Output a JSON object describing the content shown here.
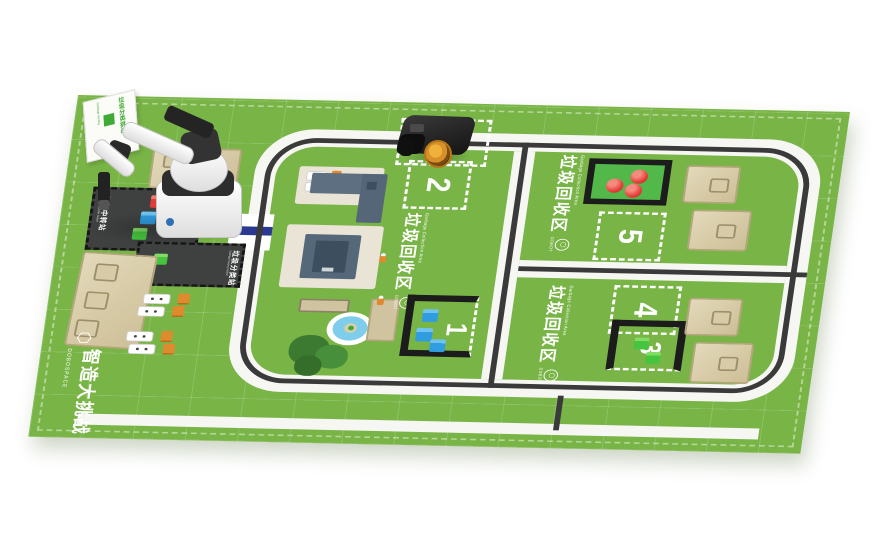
{
  "branding": {
    "logo_glyph": "⬡",
    "title_cn": "智造大挑战",
    "subtitle_en": "DOBOSPACE"
  },
  "sign": {
    "line1": "垃圾分类挑战",
    "line2": "Garbage Sorting"
  },
  "stations": {
    "transfer": {
      "cn": "垃圾中转站",
      "en": "Garbage Transfer Station"
    },
    "sorting": {
      "cn": "垃圾分类站",
      "en": "Garbage Sorting Station"
    }
  },
  "collection_area": {
    "cn": "垃圾回收区",
    "en": "Garbage Collection Area",
    "brand": "DOBOT",
    "logo_glyph": "⬡"
  },
  "zones": {
    "z1": "1",
    "z2": "2",
    "z3": "3",
    "z4": "4",
    "z5": "5"
  },
  "colors": {
    "mat_green": "#79b446",
    "road_white": "#f6f6f3",
    "line_black": "#3a3a3a",
    "pad_dark": "#3f4040",
    "tan": "#d7cba6",
    "cube_red": "#e23b3b",
    "cube_blue": "#2f9de0",
    "cube_green": "#45c53e",
    "bridge_blue": "#2b3990",
    "wheel_yellow": "#e0a32d"
  }
}
